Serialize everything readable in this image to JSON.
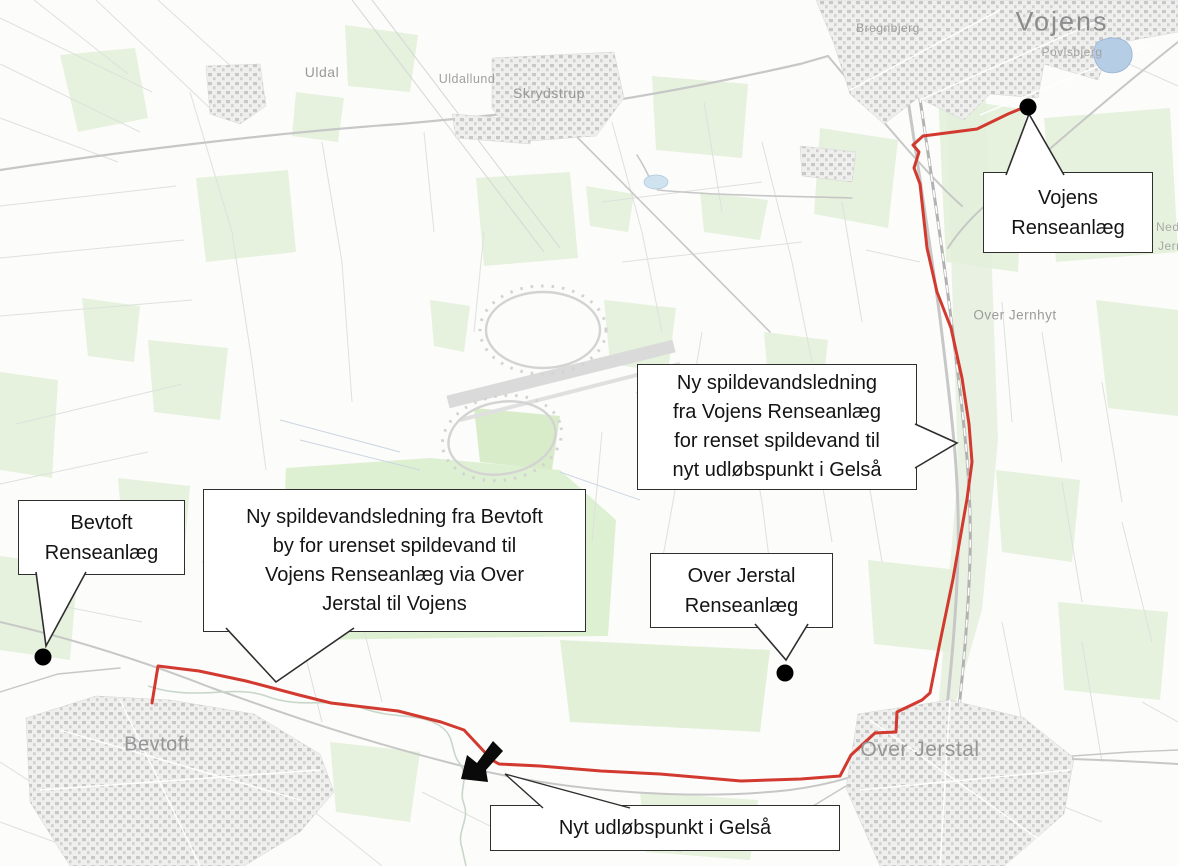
{
  "figure": {
    "kind": "pipeline-plan-map",
    "background": "#fcfcfb"
  },
  "colors": {
    "route_red": "#d23a30",
    "marker_black": "#000000",
    "callout_border": "#2e2e2e",
    "map_green": "#e6f2dd",
    "road_gray": "#c7c7c7",
    "label_gray": "#9a9a9a"
  },
  "route": {
    "color": "#d23a30",
    "marker_color": "#000000"
  },
  "callouts": {
    "vojens_plant": {
      "lines": [
        "Vojens",
        "Renseanlæg"
      ]
    },
    "vojens_outfall_line": {
      "lines": [
        "Ny spildevandsledning",
        "fra Vojens Renseanlæg",
        "for renset spildevand til",
        "nyt udløbspunkt i Gelså"
      ]
    },
    "bevtoft_plant": {
      "lines": [
        "Bevtoft",
        "Renseanlæg"
      ]
    },
    "bevtoft_line": {
      "lines": [
        "Ny spildevandsledning fra Bevtoft",
        "by for urenset spildevand til",
        "Vojens Renseanlæg via Over",
        "Jerstal til Vojens"
      ]
    },
    "over_jerstal_plant": {
      "lines": [
        "Over Jerstal",
        "Renseanlæg"
      ]
    },
    "outfall_point": {
      "lines": [
        "Nyt udløbspunkt i Gelså"
      ]
    }
  },
  "map_labels": {
    "vojens": "Vojens",
    "povlsbjerg": "Povlsbjerg",
    "bregnbjerg": "Bregnbjerg",
    "uldal": "Uldal",
    "uldallund": "Uldallund",
    "skrydstrup": "Skrydstrup",
    "over_jernhyt": "Over Jernhyt",
    "bevtoft_town": "Bevtoft",
    "over_jerstal_town": "Over Jerstal",
    "edge_partial_1": "Nede",
    "edge_partial_2": "Jernh"
  }
}
